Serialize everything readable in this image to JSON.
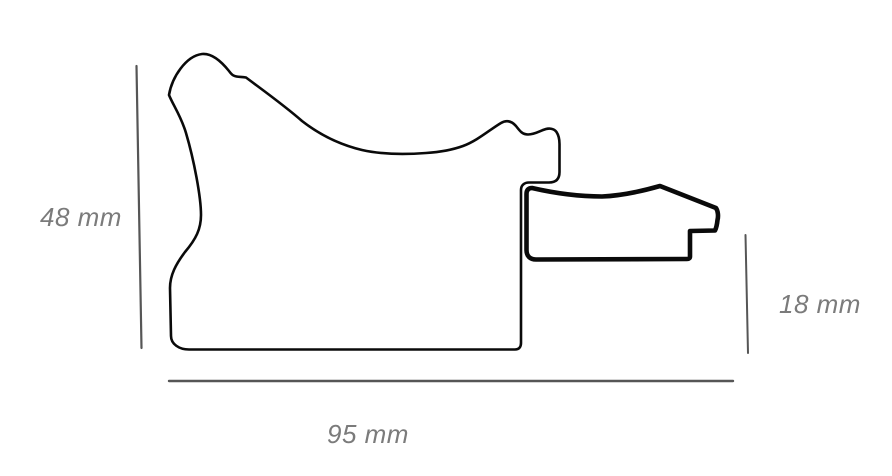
{
  "diagram": {
    "background_color": "#ffffff",
    "profile_outline_color": "#0a0a0a",
    "dimension_line_color": "#565656",
    "dimension_label_color": "#7b7b7b",
    "dimensions": {
      "height": {
        "label": "48 mm"
      },
      "width": {
        "label": "95 mm"
      },
      "depth": {
        "label": "18 mm"
      }
    }
  }
}
